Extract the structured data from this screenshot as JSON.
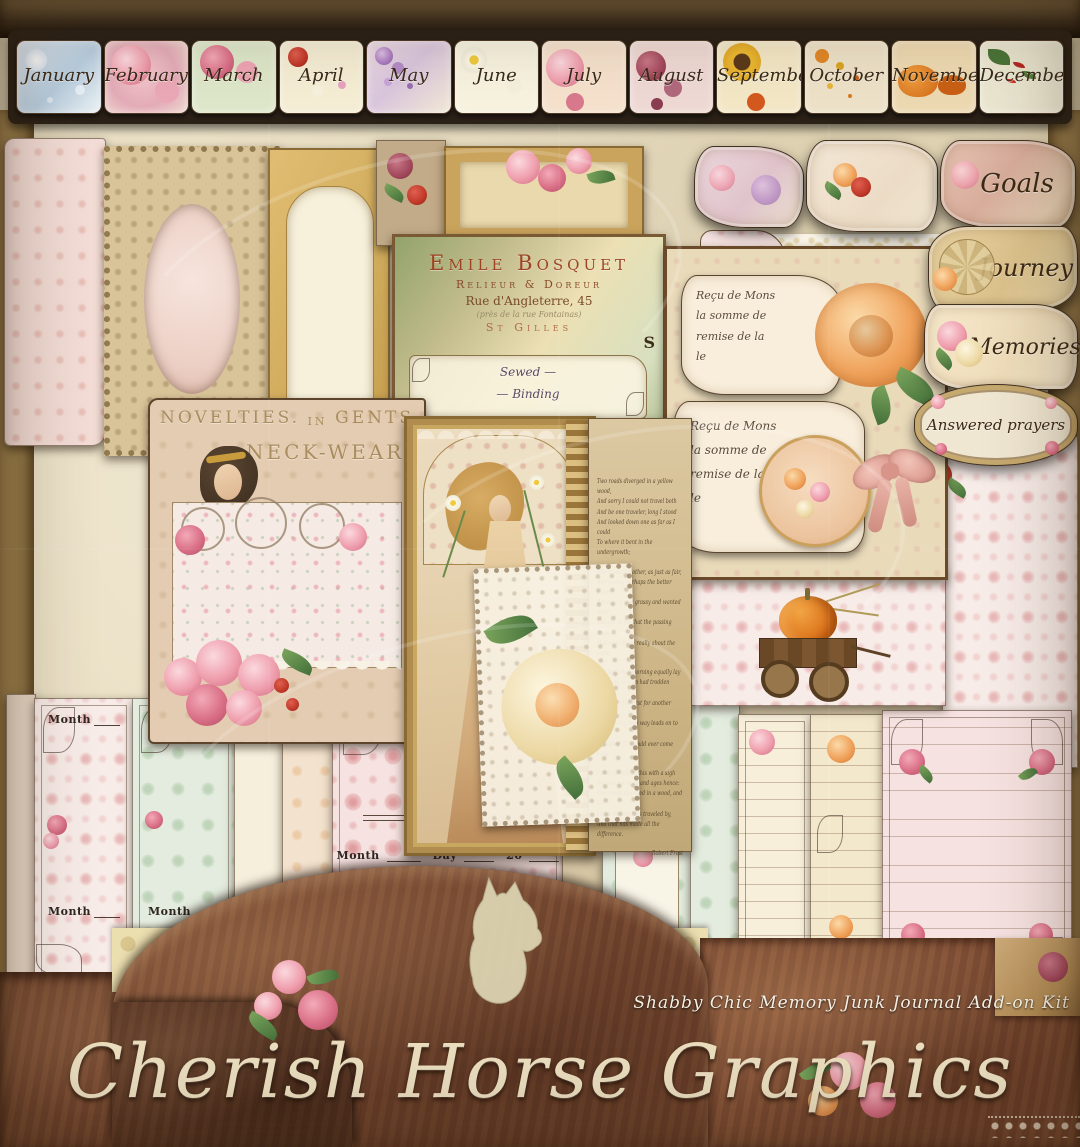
{
  "brand": {
    "name": "Cherish Horse Graphics",
    "tagline": "Shabby Chic Memory Junk Journal Add-on Kit"
  },
  "palette": {
    "parchment": "#e9dec0",
    "leather_brown": "#6f4530",
    "olive_edge": "#9c8050",
    "damask_pink": "#e8b4b4",
    "gold": "#b8924e",
    "script_ink": "#3c2a16",
    "cream": "#f4ecd6"
  },
  "months": {
    "items": [
      {
        "label": "January",
        "motif": "snowflakes"
      },
      {
        "label": "February",
        "motif": "pink-roses"
      },
      {
        "label": "March",
        "motif": "roses-on-damask"
      },
      {
        "label": "April",
        "motif": "daffodils"
      },
      {
        "label": "May",
        "motif": "lilacs"
      },
      {
        "label": "June",
        "motif": "daisies"
      },
      {
        "label": "July",
        "motif": "roses"
      },
      {
        "label": "August",
        "motif": "burgundy-blooms"
      },
      {
        "label": "September",
        "motif": "sunflower"
      },
      {
        "label": "October",
        "motif": "autumn-leaves"
      },
      {
        "label": "November",
        "motif": "pumpkins"
      },
      {
        "label": "December",
        "motif": "holly"
      }
    ]
  },
  "labels": {
    "goals": "Goals",
    "journey": "Journey",
    "memories": "Memories",
    "answered_prayers": "Answered  prayers"
  },
  "bosquet_card": {
    "title": "Emile Bosquet",
    "trade": "Relieur & Doreur",
    "address": "Rue d'Angleterre, 45",
    "note": "(près de la rue Fontainas)",
    "city": "St Gilles",
    "initial": "S",
    "script": "Sewed —\n— Binding"
  },
  "novelties_card": {
    "word1": "Novelties.",
    "word2": "in",
    "word3": "Gents",
    "word4": "Neck-wear"
  },
  "receipt_card": {
    "script": "Reçu de  Mons\nla somme de\nremise de la\nle"
  },
  "poem": {
    "stanza1": "Two roads diverged in a yellow wood,\nAnd sorry I could not travel both\nAnd be one traveler, long I stood\nAnd looked down one as far as I could\nTo where it bent in the undergrowth;",
    "stanza2": "Then took the other, as just as fair,\nAnd having perhaps the better claim,\nBecause it was grassy and wanted wear;\nThough as for that the passing there\nHad worn them really about the same,",
    "stanza3": "And both that morning equally lay\nIn leaves no step had trodden black.\nOh, I kept the first for another day!\nYet knowing how way leads on to way,\nI doubted if I should ever come back.",
    "stanza4": "I shall be telling this with a sigh\nSomewhere ages and ages hence:\nTwo roads diverged in a wood, and I—\nI took the one less traveled by,\nAnd that has made all the difference.",
    "signature": "Robert Frost"
  },
  "journal_tags": {
    "month_label": "Month",
    "day_label": "Day",
    "year_prefix": "20"
  }
}
